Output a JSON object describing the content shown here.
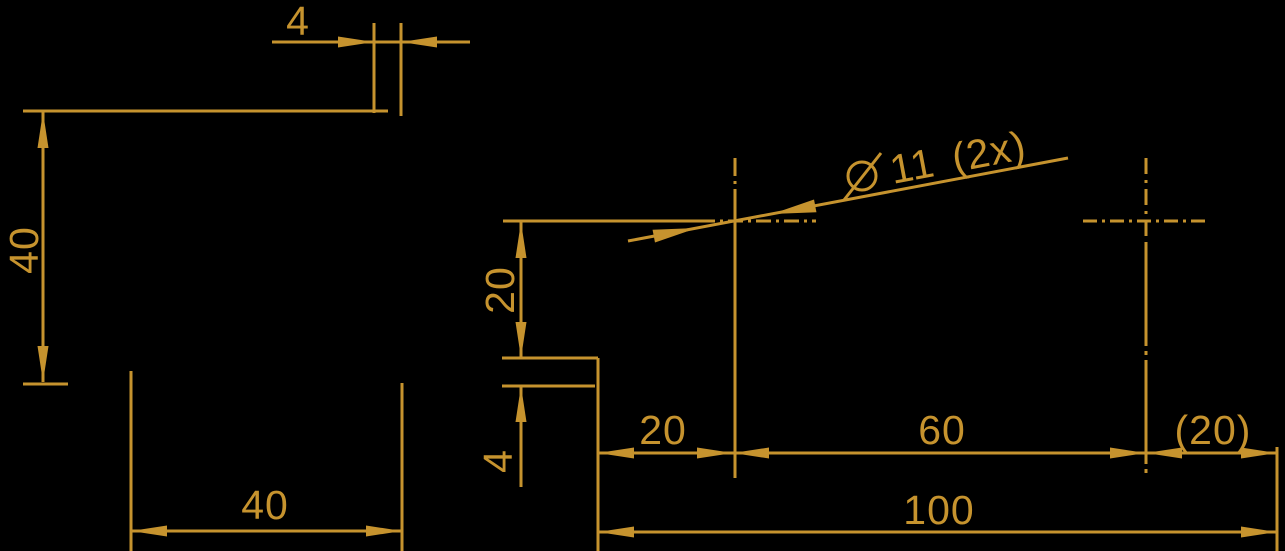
{
  "drawing": {
    "width": 1285,
    "height": 551,
    "background_color": "#000000",
    "stroke_color": "#C6932E"
  },
  "labels": [
    {
      "id": "dim-width-4",
      "text": "4",
      "x": 298,
      "y": 35,
      "rotate": 0
    },
    {
      "id": "dim-height-40",
      "text": "40",
      "x": 38,
      "y": 250,
      "rotate": -90
    },
    {
      "id": "dim-width-40",
      "text": "40",
      "x": 265,
      "y": 519,
      "rotate": 0
    },
    {
      "id": "dim-offset-20",
      "text": "20",
      "x": 514,
      "y": 290,
      "rotate": -90
    },
    {
      "id": "dim-step-4",
      "text": "4",
      "x": 512,
      "y": 461,
      "rotate": -90
    },
    {
      "id": "dim-chain-20",
      "text": "20",
      "x": 663,
      "y": 444,
      "rotate": 0
    },
    {
      "id": "dim-chain-60",
      "text": "60",
      "x": 942,
      "y": 444,
      "rotate": 0
    },
    {
      "id": "dim-chain-20-ref",
      "text": "(20)",
      "x": 1213,
      "y": 444,
      "rotate": 0
    },
    {
      "id": "dim-overall-100",
      "text": "100",
      "x": 939,
      "y": 524,
      "rotate": 0
    }
  ],
  "hole_callout": {
    "full_text": "⌀ 11 (2x)",
    "text_after_symbol": "11 (2x)",
    "x": 893,
    "y": 184,
    "angle": -10.7,
    "symbol": {
      "cx": 862,
      "cy": 176,
      "r": 14,
      "slash_x1": 844,
      "slash_y1": 200,
      "slash_x2": 881,
      "slash_y2": 153
    }
  },
  "geometry": {
    "lines": [
      {
        "n": "top-edge-line",
        "x1": 23,
        "y1": 111,
        "x2": 388,
        "y2": 111
      },
      {
        "n": "ext-line-step-left",
        "x1": 374,
        "y1": 23,
        "x2": 374,
        "y2": 113
      },
      {
        "n": "ext-line-step-right",
        "x1": 401,
        "y1": 23,
        "x2": 401,
        "y2": 116
      },
      {
        "n": "dim4-line-left",
        "x1": 272,
        "y1": 42,
        "x2": 374,
        "y2": 42
      },
      {
        "n": "dim4-line-mid",
        "x1": 374,
        "y1": 42,
        "x2": 401,
        "y2": 42
      },
      {
        "n": "dim4-line-right",
        "x1": 401,
        "y1": 42,
        "x2": 470,
        "y2": 42
      },
      {
        "n": "dim40-left-line",
        "x1": 43,
        "y1": 112,
        "x2": 43,
        "y2": 382
      },
      {
        "n": "tick-line-bottom",
        "x1": 23,
        "y1": 384,
        "x2": 68,
        "y2": 384
      },
      {
        "n": "edge-line-left-a",
        "x1": 131,
        "y1": 371,
        "x2": 131,
        "y2": 551
      },
      {
        "n": "edge-line-left-b",
        "x1": 402,
        "y1": 383,
        "x2": 402,
        "y2": 551
      },
      {
        "n": "dim40-bottom-line",
        "x1": 131,
        "y1": 531,
        "x2": 402,
        "y2": 531
      },
      {
        "n": "hole-ext-line",
        "x1": 503,
        "y1": 221,
        "x2": 702,
        "y2": 221
      },
      {
        "n": "dim20-vert-line",
        "x1": 521,
        "y1": 222,
        "x2": 521,
        "y2": 358
      },
      {
        "n": "step-line-upper",
        "x1": 502,
        "y1": 358,
        "x2": 598,
        "y2": 358
      },
      {
        "n": "step-line-lower",
        "x1": 502,
        "y1": 386,
        "x2": 595,
        "y2": 386
      },
      {
        "n": "dim4-vert-tail",
        "x1": 521,
        "y1": 386,
        "x2": 521,
        "y2": 487
      },
      {
        "n": "edge-line-right-view",
        "x1": 598,
        "y1": 358,
        "x2": 598,
        "y2": 551
      },
      {
        "n": "chain-dim-line",
        "x1": 598,
        "y1": 453,
        "x2": 1277,
        "y2": 453
      },
      {
        "n": "ext-line-right-end",
        "x1": 1277,
        "y1": 447,
        "x2": 1277,
        "y2": 551
      },
      {
        "n": "dim100-line",
        "x1": 598,
        "y1": 532,
        "x2": 1277,
        "y2": 532
      },
      {
        "n": "leader-line",
        "x1": 628,
        "y1": 241,
        "x2": 1068,
        "y2": 158
      },
      {
        "n": "centerline-h-left",
        "x1": 700,
        "y1": 221,
        "x2": 816,
        "y2": 221,
        "dash": "15 5 3 5"
      },
      {
        "n": "centerline-h-right",
        "x1": 1083,
        "y1": 221,
        "x2": 1208,
        "y2": 221,
        "dash": "14 5 3 5"
      },
      {
        "n": "centerline-v-left-top",
        "x1": 735,
        "y1": 158,
        "x2": 735,
        "y2": 190,
        "dash": "18 5 3 5"
      },
      {
        "n": "centerline-v-left",
        "x1": 735,
        "y1": 190,
        "x2": 735,
        "y2": 478
      },
      {
        "n": "centerline-v-right-top",
        "x1": 1146,
        "y1": 158,
        "x2": 1146,
        "y2": 242,
        "dash": "16 6 3 6"
      },
      {
        "n": "centerline-v-right",
        "x1": 1146,
        "y1": 242,
        "x2": 1146,
        "y2": 473,
        "dash": "104 5 4 5"
      }
    ],
    "arrows": [
      {
        "n": "arrow-dim4-right",
        "tx": 374,
        "ty": 42,
        "ang": 0
      },
      {
        "n": "arrow-dim4-left",
        "tx": 401,
        "ty": 42,
        "ang": 180
      },
      {
        "n": "arrow-dim40-up",
        "tx": 43,
        "ty": 112,
        "ang": -90
      },
      {
        "n": "arrow-dim40-down",
        "tx": 43,
        "ty": 382,
        "ang": 90
      },
      {
        "n": "arrow-dim40b-left",
        "tx": 131,
        "ty": 531,
        "ang": 180
      },
      {
        "n": "arrow-dim40b-right",
        "tx": 402,
        "ty": 531,
        "ang": 0
      },
      {
        "n": "arrow-dim20v-up",
        "tx": 521,
        "ty": 222,
        "ang": -90
      },
      {
        "n": "arrow-dim20v-down",
        "tx": 521,
        "ty": 358,
        "ang": 90
      },
      {
        "n": "arrow-dim4v-up",
        "tx": 521,
        "ty": 386,
        "ang": -90
      },
      {
        "n": "arrow-chain20-left",
        "tx": 598,
        "ty": 453,
        "ang": 180
      },
      {
        "n": "arrow-chain20-right",
        "tx": 733,
        "ty": 453,
        "ang": 0
      },
      {
        "n": "arrow-chain60-left",
        "tx": 733,
        "ty": 453,
        "ang": 180
      },
      {
        "n": "arrow-chain60-right",
        "tx": 1146,
        "ty": 453,
        "ang": 0
      },
      {
        "n": "arrow-chain20ref-left",
        "tx": 1146,
        "ty": 453,
        "ang": 180
      },
      {
        "n": "arrow-chain20ref-right",
        "tx": 1277,
        "ty": 453,
        "ang": 0
      },
      {
        "n": "arrow-dim100-left",
        "tx": 598,
        "ty": 532,
        "ang": 180
      },
      {
        "n": "arrow-dim100-right",
        "tx": 1277,
        "ty": 532,
        "ang": 0
      },
      {
        "n": "arrow-leader-lower",
        "tx": 697,
        "ty": 228,
        "ang": -10.7,
        "len": 44,
        "hw": 6.5
      },
      {
        "n": "arrow-leader-upper",
        "tx": 772,
        "ty": 214,
        "ang": 169.3,
        "len": 44,
        "hw": 6.5
      }
    ]
  }
}
